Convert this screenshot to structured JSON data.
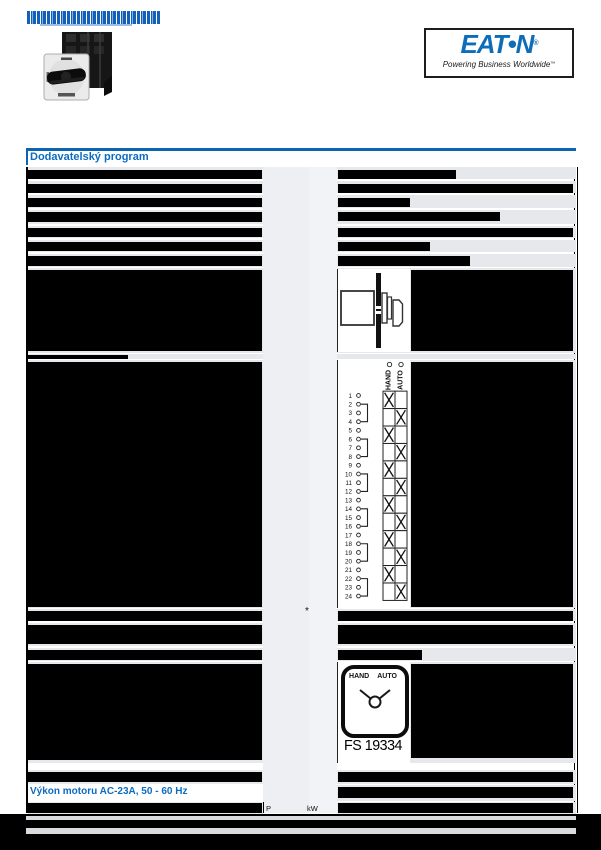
{
  "header": {
    "title_redacted": true,
    "logo": {
      "brand": "EAT•N",
      "registered": "®",
      "tagline": "Powering Business Worldwide",
      "trademark": "™"
    }
  },
  "section": {
    "title": "Dodavatelský program"
  },
  "subsection": {
    "title": "Výkon motoru AC-23A, 50 - 60 Hz"
  },
  "units": {
    "quantity_symbol": "P",
    "unit": "kW"
  },
  "footnote_marker": "*",
  "contact_diagram": {
    "type": "table",
    "position_columns": [
      "HAND",
      "AUTO"
    ],
    "terminal_count": 24,
    "bridged_terminal_pairs": [
      [
        2,
        4
      ],
      [
        6,
        8
      ],
      [
        10,
        12
      ],
      [
        14,
        16
      ],
      [
        18,
        20
      ],
      [
        22,
        24
      ]
    ],
    "contact_rows": [
      {
        "terminals": [
          1,
          2
        ],
        "closed_in": "HAND"
      },
      {
        "terminals": [
          3,
          4
        ],
        "closed_in": "AUTO"
      },
      {
        "terminals": [
          5,
          6
        ],
        "closed_in": "HAND"
      },
      {
        "terminals": [
          7,
          8
        ],
        "closed_in": "AUTO"
      },
      {
        "terminals": [
          9,
          10
        ],
        "closed_in": "HAND"
      },
      {
        "terminals": [
          11,
          12
        ],
        "closed_in": "AUTO"
      },
      {
        "terminals": [
          13,
          14
        ],
        "closed_in": "HAND"
      },
      {
        "terminals": [
          15,
          16
        ],
        "closed_in": "AUTO"
      },
      {
        "terminals": [
          17,
          18
        ],
        "closed_in": "HAND"
      },
      {
        "terminals": [
          19,
          20
        ],
        "closed_in": "AUTO"
      },
      {
        "terminals": [
          21,
          22
        ],
        "closed_in": "HAND"
      },
      {
        "terminals": [
          23,
          24
        ],
        "closed_in": "AUTO"
      }
    ]
  },
  "front_plate": {
    "left_label": "HAND",
    "right_label": "AUTO",
    "code": "FS 19334"
  },
  "colors": {
    "accent_blue": "#0c6cc0",
    "logo_blue": "#0e6db8",
    "row_bg": "#e7e8eb",
    "redaction": "#000000"
  }
}
